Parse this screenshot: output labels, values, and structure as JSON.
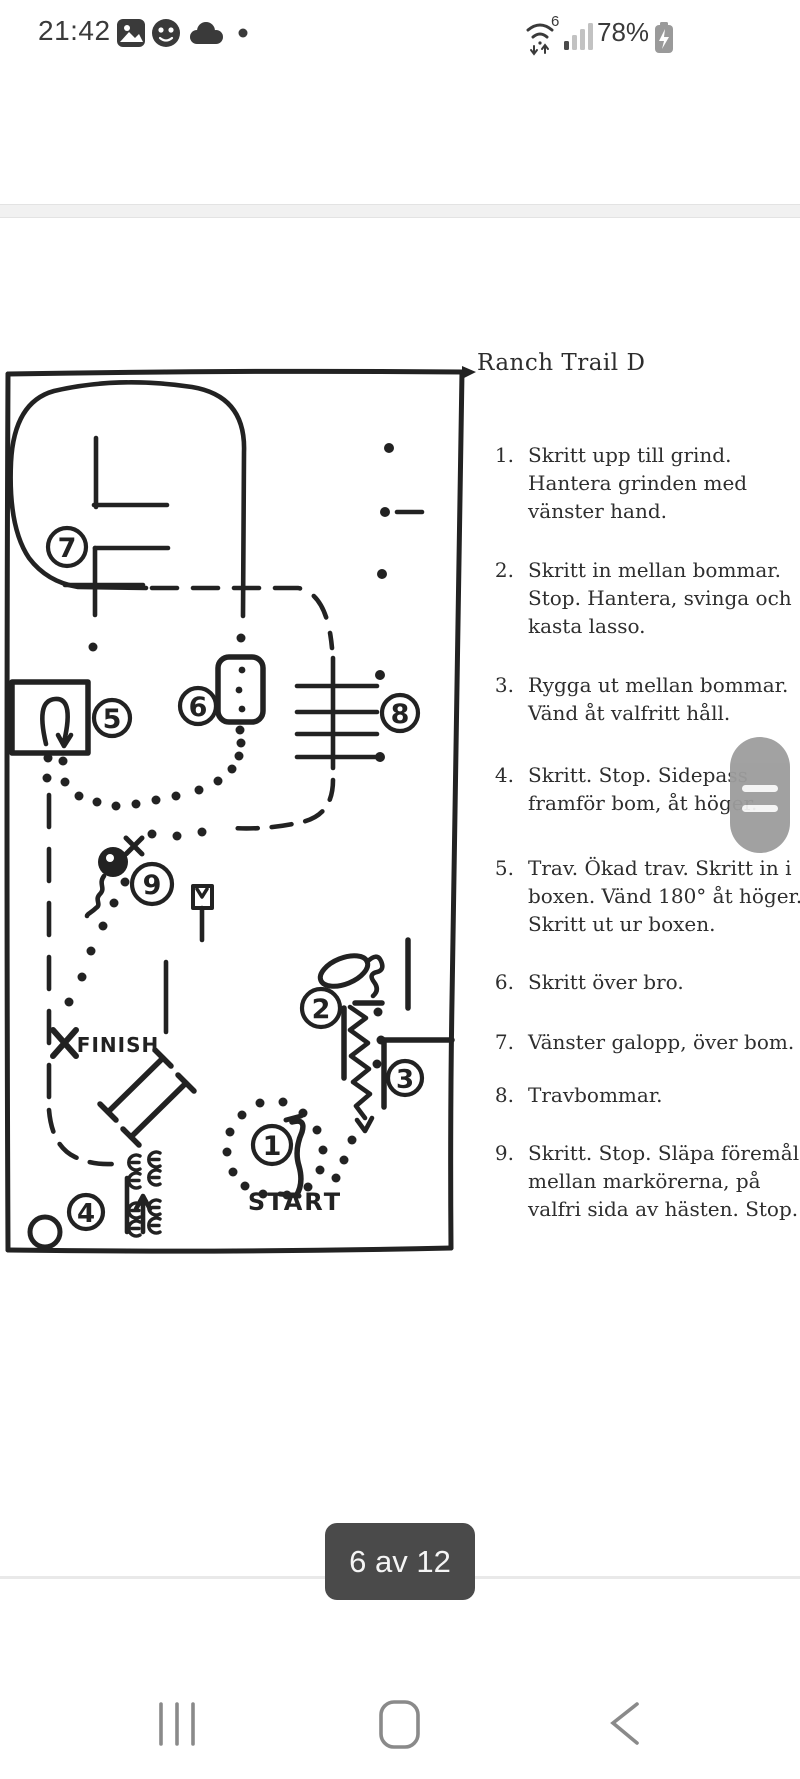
{
  "status_bar": {
    "time": "21:42",
    "battery_percent": "78%",
    "icon_names": [
      "gallery-icon",
      "avatar-icon",
      "cloud-icon",
      "notification-dot",
      "wifi6-icon",
      "signal-icon",
      "battery-charging-icon"
    ]
  },
  "document": {
    "title": "Ranch Trail D",
    "instructions": [
      {
        "number": "1.",
        "text": "Skritt upp till grind. Hantera grinden med vänster hand."
      },
      {
        "number": "2.",
        "text": "Skritt in mellan bommar. Stop. Hantera, svinga och kasta lasso."
      },
      {
        "number": "3.",
        "text": "Rygga ut mellan bommar. Vänd åt valfritt håll."
      },
      {
        "number": "4.",
        "text": "Skritt. Stop. Sidepass framför bom, åt höger."
      },
      {
        "number": "5.",
        "text": "Trav. Ökad trav. Skritt in i boxen. Vänd 180° åt höger. Skritt ut ur boxen."
      },
      {
        "number": "6.",
        "text": "Skritt över bro."
      },
      {
        "number": "7.",
        "text": "Vänster galopp, över bom."
      },
      {
        "number": "8.",
        "text": "Travbommar."
      },
      {
        "number": "9.",
        "text": "Skritt. Stop. Släpa föremål mellan markörerna, på valfri sida av hästen. Stop."
      }
    ],
    "map_labels": {
      "start": "START",
      "finish": "FINISH",
      "stations": [
        "1",
        "2",
        "3",
        "4",
        "5",
        "6",
        "7",
        "8",
        "9"
      ]
    }
  },
  "pager": {
    "label": "6 av 12"
  },
  "colors": {
    "ink": "#222222",
    "status_icon": "#3a3a3a",
    "nav_icon": "#8a8a8a",
    "badge_bg": "#4a4a4a",
    "handle_gray": "#9d9d9d",
    "page_gap": "#f1f1f1"
  }
}
